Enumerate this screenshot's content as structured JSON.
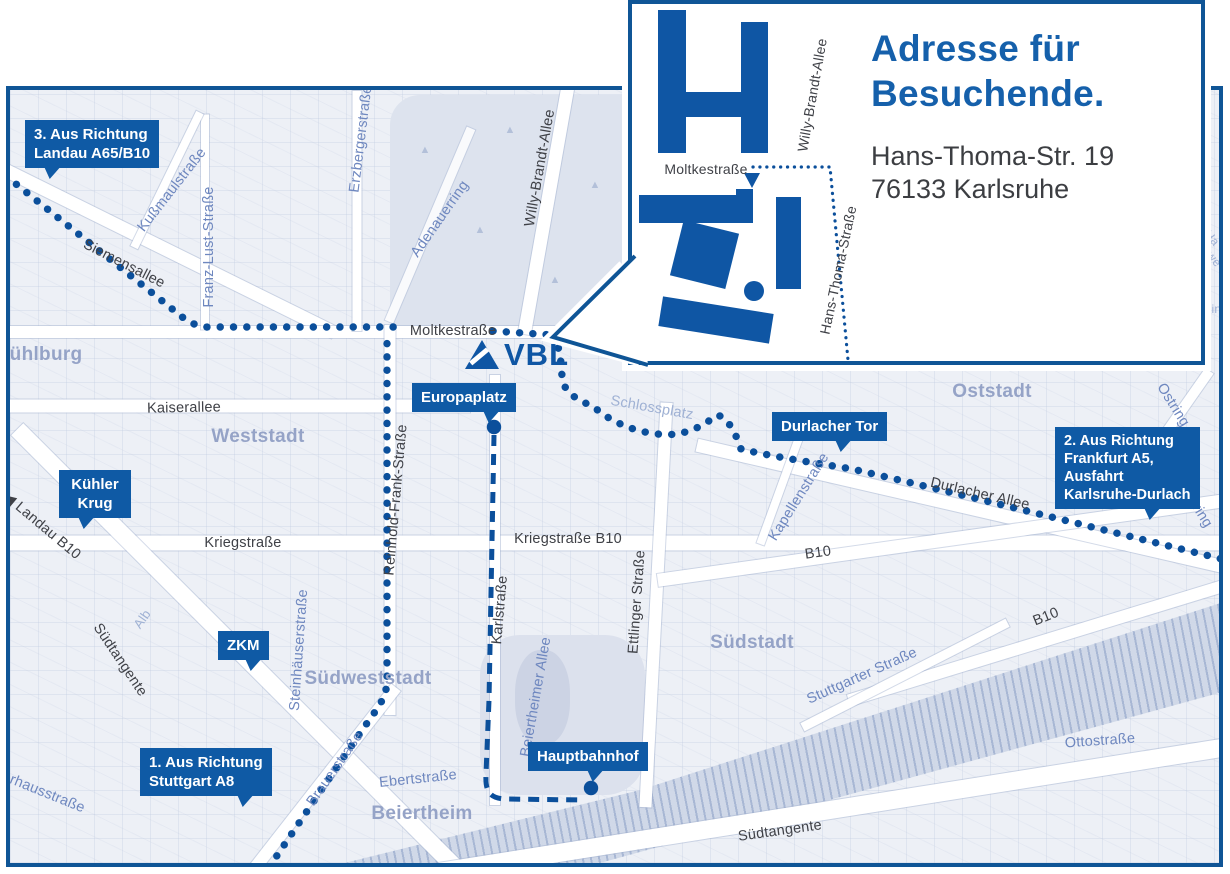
{
  "logo": {
    "text": "VBL"
  },
  "inset": {
    "title": [
      "Adresse für",
      "Besuchende."
    ],
    "address": [
      "Hans-Thoma-Str. 19",
      "76133 Karlsruhe"
    ]
  },
  "badges": [
    {
      "id": "landau",
      "lines": [
        "3. Aus Richtung",
        "Landau A65/B10"
      ]
    },
    {
      "id": "kuehler-krug",
      "lines": [
        "Kühler",
        "Krug"
      ]
    },
    {
      "id": "zkm",
      "lines": [
        "ZKM"
      ]
    },
    {
      "id": "stuttgart",
      "lines": [
        "1. Aus Richtung",
        "Stuttgart A8"
      ]
    },
    {
      "id": "europaplatz",
      "lines": [
        "Europaplatz"
      ]
    },
    {
      "id": "durlacher-tor",
      "lines": [
        "Durlacher Tor"
      ]
    },
    {
      "id": "hauptbahnhof",
      "lines": [
        "Hauptbahnhof"
      ]
    },
    {
      "id": "frankfurt",
      "lines": [
        "2. Aus Richtung",
        "Frankfurt A5,",
        "Ausfahrt",
        "Karlsruhe-Durlach"
      ]
    }
  ],
  "streets": {
    "siemensallee": "Siemensallee",
    "kussmaulstrasse": "Kußmaulstraße",
    "franz_lust": "Franz-Lust-Straße",
    "erzberger": "Erzbergerstraße",
    "willy_brandt": "Willy-Brandt-Allee",
    "adenauerring": "Adenauerring",
    "moltkestrasse": "Moltkestraße",
    "kaiserallee": "Kaiserallee",
    "reinhold_frank": "Reinhold-Frank-Straße",
    "schlossplatz": "Schlossplatz",
    "kriegstrasse": "Kriegstraße",
    "kriegstrasse_b10": "Kriegstraße B10",
    "karlstrasse": "Karlstraße",
    "ettlinger": "Ettlinger Straße",
    "durlacher_allee": "Durlacher Allee",
    "kapellenstrasse": "Kapellenstraße",
    "ostring": "Ostring",
    "b10": "B10",
    "stuttgarter": "Stuttgarter Straße",
    "ottostrasse": "Ottostraße",
    "suedtangente": "Südtangente",
    "brauerstrasse": "Brauerstraße",
    "ebertstrasse": "Ebertstraße",
    "beiertheimer_allee": "Beiertheimer Allee",
    "steinhaeuser": "Steinhäuserstraße",
    "alb": "Alb",
    "landau_arrow": "◀",
    "landau_b10": "Landau B10",
    "pulverhaus": "Pulverhausstraße",
    "hans_thoma": "Hans-Thoma-Straße"
  },
  "districts": {
    "muehlburg": "Mühlburg",
    "weststadt": "Weststadt",
    "oststadt": "Oststadt",
    "suedstadt": "Südstadt",
    "suedweststadt": "Südweststadt",
    "beiertheim": "Beiertheim"
  },
  "fragments": [
    "Ha",
    "we",
    "ein"
  ],
  "colors": {
    "accent": "#0f5aa5",
    "route": "#0b4f9b",
    "border": "#0f5596",
    "title": "#1560ab"
  }
}
